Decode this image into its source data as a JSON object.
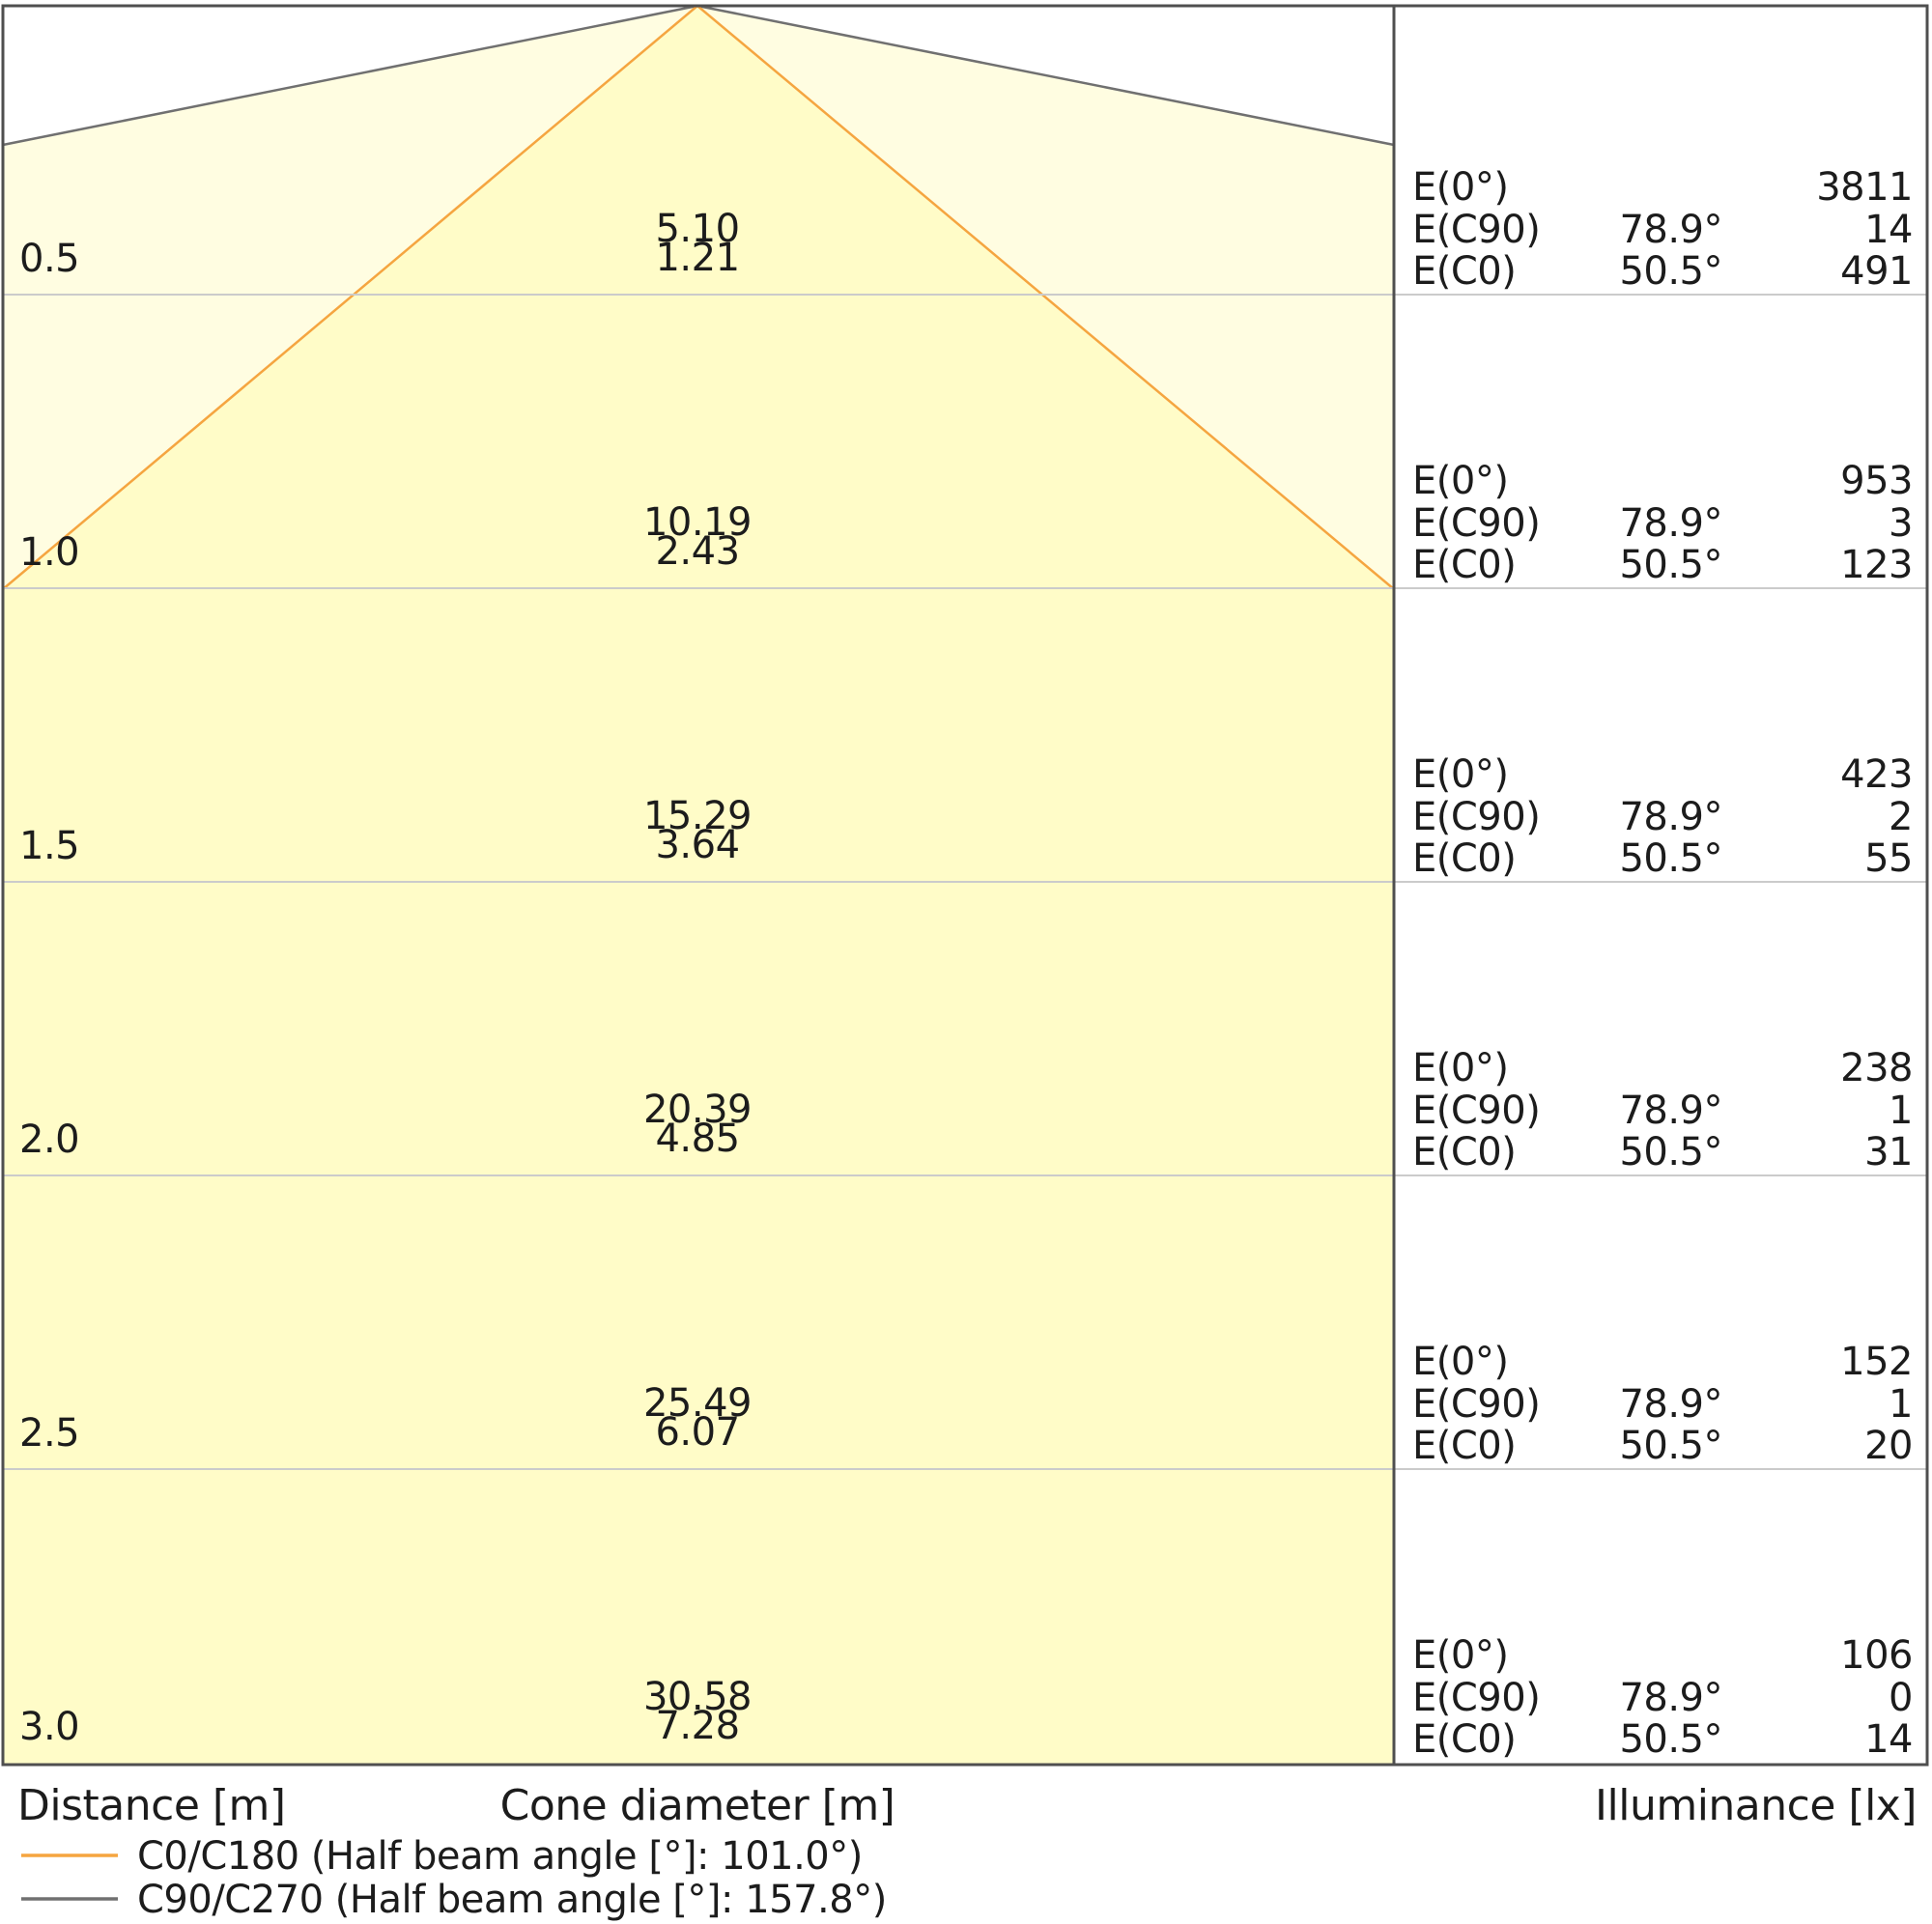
{
  "colors": {
    "cone_outer_fill": "#FFFDE1",
    "cone_inner_fill": "#FFFCC8",
    "c0_line": "#F5A540",
    "c90_line": "#707070"
  },
  "axis": {
    "distance_label": "Distance [m]",
    "cone_diameter_label": "Cone diameter [m]",
    "illuminance_label": "Illuminance [lx]"
  },
  "legend": {
    "c0_label": "C0/C180 (Half beam angle [°]: 101.0°)",
    "c90_label": "C90/C270 (Half beam angle [°]: 157.8°)"
  },
  "table": {
    "e0_label": "E(0°)",
    "ec90_label": "E(C90)",
    "ec0_label": "E(C0)",
    "ec90_angle": "78.9°",
    "ec0_angle": "50.5°"
  },
  "rows": [
    {
      "distance": "0.5",
      "cone_c90": "5.10",
      "cone_c0": "1.21",
      "e0": "3811",
      "ec90": "14",
      "ec0": "491"
    },
    {
      "distance": "1.0",
      "cone_c90": "10.19",
      "cone_c0": "2.43",
      "e0": "953",
      "ec90": "3",
      "ec0": "123"
    },
    {
      "distance": "1.5",
      "cone_c90": "15.29",
      "cone_c0": "3.64",
      "e0": "423",
      "ec90": "2",
      "ec0": "55"
    },
    {
      "distance": "2.0",
      "cone_c90": "20.39",
      "cone_c0": "4.85",
      "e0": "238",
      "ec90": "1",
      "ec0": "31"
    },
    {
      "distance": "2.5",
      "cone_c90": "25.49",
      "cone_c0": "6.07",
      "e0": "152",
      "ec90": "1",
      "ec0": "20"
    },
    {
      "distance": "3.0",
      "cone_c90": "30.58",
      "cone_c0": "7.28",
      "e0": "106",
      "ec90": "0",
      "ec0": "14"
    }
  ],
  "chart_data": {
    "type": "table",
    "title": "Light cone diagram",
    "xlabel": "Distance [m]",
    "x": [
      0.5,
      1.0,
      1.5,
      2.0,
      2.5,
      3.0
    ],
    "series": [
      {
        "name": "Cone diameter C90/C270 [m]",
        "values": [
          5.1,
          10.19,
          15.29,
          20.39,
          25.49,
          30.58
        ]
      },
      {
        "name": "Cone diameter C0/C180 [m]",
        "values": [
          1.21,
          2.43,
          3.64,
          4.85,
          6.07,
          7.28
        ]
      },
      {
        "name": "Illuminance E(0°) [lx]",
        "values": [
          3811,
          953,
          423,
          238,
          152,
          106
        ]
      },
      {
        "name": "Illuminance E(C90) at 78.9° [lx]",
        "values": [
          14,
          3,
          2,
          1,
          1,
          0
        ]
      },
      {
        "name": "Illuminance E(C0) at 50.5° [lx]",
        "values": [
          491,
          123,
          55,
          31,
          20,
          14
        ]
      }
    ],
    "legend_entries": [
      "C0/C180 (Half beam angle [°]: 101.0°)",
      "C90/C270 (Half beam angle [°]: 157.8°)"
    ],
    "half_beam_angle_c0_deg": 101.0,
    "half_beam_angle_c90_deg": 157.8,
    "legend_position": "bottom-left",
    "grid": "horizontal rows every 0.5 m"
  }
}
